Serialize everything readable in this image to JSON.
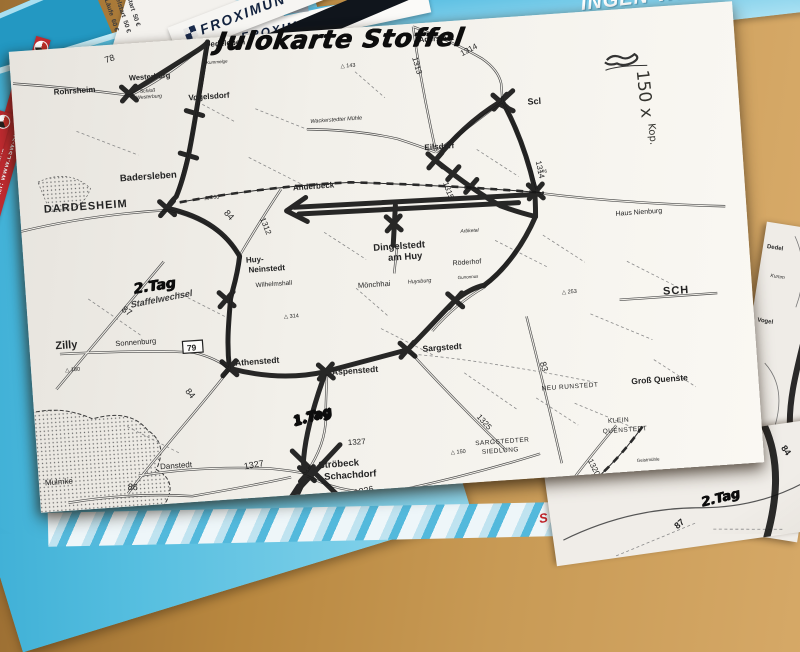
{
  "handwriting": {
    "title": "Julokarte Stoffel",
    "copies": "150 x",
    "copies_unit": "Kop.",
    "day1": "1.Tag",
    "day2": "2.Tag",
    "relay": "Staffelwechsel",
    "day2_other_sheet": "2.Tag"
  },
  "flyers": {
    "froximun": "FROXIMUN",
    "banner_big": "INGEN-WER",
    "banner_dates": "m 31.07.-03.08.201",
    "banner_small": "berstadt",
    "stripe_text": "Alle weiteren Info's und Wettkampfunterlagen unter: WWW.LSW-SPEZIAL",
    "ticket_distances": "7,5 km:\n15 km:\n22,5 k",
    "ticket_prices": "Einzelstart  50 €\nDoppelstart  50 €\nAlle Läufe  60 €",
    "ticket_red": "St",
    "bottom_red": "S"
  },
  "under_sheet": {
    "labels": [
      {
        "t": "Dedel"
      },
      {
        "t": "Kumm"
      },
      {
        "t": "Vogel"
      }
    ]
  },
  "second_sheet": {
    "road": "87",
    "marker_road": "84",
    "day": "2.Tag"
  },
  "map": {
    "towns": [
      {
        "t": "Dedeleben",
        "x": 196,
        "y": 9,
        "s": 8,
        "w": 700
      },
      {
        "t": "Westerburg",
        "x": 118,
        "y": 37,
        "s": 7.5,
        "w": 700
      },
      {
        "t": "Schloß",
        "x": 128,
        "y": 50,
        "s": 5,
        "i": 1
      },
      {
        "t": "Westerburg",
        "x": 124,
        "y": 56,
        "s": 5,
        "i": 1
      },
      {
        "t": "Rohrsheim",
        "x": 42,
        "y": 46,
        "s": 8,
        "w": 700
      },
      {
        "t": "Vogelsdorf",
        "x": 176,
        "y": 61,
        "s": 8,
        "w": 700
      },
      {
        "t": "Kummelge",
        "x": 196,
        "y": 26,
        "s": 4.5,
        "i": 1
      },
      {
        "t": "Aderstadt",
        "x": 410,
        "y": 19,
        "s": 7.5,
        "w": 700
      },
      {
        "t": "Wackerstedter Mühle",
        "x": 296,
        "y": 92,
        "s": 5.5,
        "i": 1
      },
      {
        "t": "Eilsdorf",
        "x": 408,
        "y": 127,
        "s": 8,
        "w": 700
      },
      {
        "t": "Scl",
        "x": 514,
        "y": 89,
        "s": 9,
        "w": 700
      },
      {
        "t": "Badersleben",
        "x": 102,
        "y": 137,
        "s": 9.5,
        "w": 700
      },
      {
        "t": "Anderbeck",
        "x": 274,
        "y": 158,
        "s": 8,
        "w": 700
      },
      {
        "t": "DARDESHEIM",
        "x": 24,
        "y": 163,
        "s": 11,
        "w": 700,
        "sp": 1
      },
      {
        "t": "Haus Nienburg",
        "x": 594,
        "y": 206,
        "s": 7
      },
      {
        "t": "Huy-",
        "x": 222,
        "y": 227,
        "s": 8,
        "w": 700
      },
      {
        "t": "Neinstedt",
        "x": 224,
        "y": 237,
        "s": 8,
        "w": 700
      },
      {
        "t": "Wilhelmshall",
        "x": 230,
        "y": 252,
        "s": 6.5
      },
      {
        "t": "Dingelstedt",
        "x": 350,
        "y": 224,
        "s": 9.5,
        "w": 700
      },
      {
        "t": "am Huy",
        "x": 364,
        "y": 235,
        "s": 9.5,
        "w": 700
      },
      {
        "t": "Mönchhai",
        "x": 332,
        "y": 260,
        "s": 7.5
      },
      {
        "t": "Huysburg",
        "x": 382,
        "y": 259,
        "s": 5.5,
        "i": 1
      },
      {
        "t": "Röderhof",
        "x": 428,
        "y": 244,
        "s": 7
      },
      {
        "t": "Gunonnus",
        "x": 432,
        "y": 258,
        "s": 4.5,
        "i": 1
      },
      {
        "t": "Arbketal",
        "x": 438,
        "y": 212,
        "s": 5,
        "i": 1
      },
      {
        "t": "SCH",
        "x": 636,
        "y": 288,
        "s": 11,
        "w": 700,
        "sp": 1
      },
      {
        "t": "Zilly",
        "x": 26,
        "y": 300,
        "s": 11,
        "w": 700
      },
      {
        "t": "Sonnenburg",
        "x": 86,
        "y": 301,
        "s": 7.5
      },
      {
        "t": "Athenstedt",
        "x": 204,
        "y": 329,
        "s": 8.5,
        "w": 700
      },
      {
        "t": "Mulmke",
        "x": 6,
        "y": 435,
        "s": 8
      },
      {
        "t": "Danstedt",
        "x": 122,
        "y": 427,
        "s": 8
      },
      {
        "t": "Aspenstedt",
        "x": 300,
        "y": 345,
        "s": 8.5,
        "w": 700
      },
      {
        "t": "Sargstedt",
        "x": 392,
        "y": 328,
        "s": 8.5,
        "w": 700
      },
      {
        "t": "SARGSTEDTER",
        "x": 438,
        "y": 425,
        "s": 6.5,
        "sp": 0.5
      },
      {
        "t": "SIEDLUNG",
        "x": 444,
        "y": 434,
        "s": 6.5,
        "sp": 0.5
      },
      {
        "t": "Ströbeck",
        "x": 280,
        "y": 437,
        "s": 9.5,
        "w": 700
      },
      {
        "t": "Schachdorf",
        "x": 285,
        "y": 449,
        "s": 9.5,
        "w": 700
      },
      {
        "t": "NEU RUNSTEDT",
        "x": 508,
        "y": 375,
        "s": 6.5,
        "sp": 0.5
      },
      {
        "t": "Groß Quenste",
        "x": 598,
        "y": 375,
        "s": 8.5,
        "w": 700
      },
      {
        "t": "KLEIN",
        "x": 572,
        "y": 412,
        "s": 6.5,
        "sp": 0.5
      },
      {
        "t": "QUENSTEDT",
        "x": 566,
        "y": 422,
        "s": 6.5,
        "sp": 0.5
      },
      {
        "t": "WEHRSTEDT",
        "x": 538,
        "y": 467,
        "s": 7,
        "sp": 0.5
      },
      {
        "t": "Geistmühle",
        "x": 598,
        "y": 453,
        "s": 4.5
      }
    ],
    "road_numbers": [
      {
        "t": "78",
        "x": 96,
        "y": 18,
        "r": -14,
        "s": 9
      },
      {
        "t": "84",
        "x": 203,
        "y": 176,
        "r": 52,
        "s": 9
      },
      {
        "t": "1312",
        "x": 239,
        "y": 184,
        "r": 72,
        "s": 8
      },
      {
        "t": "87",
        "x": 94,
        "y": 266,
        "r": 38,
        "s": 9
      },
      {
        "t": "84",
        "x": 152,
        "y": 351,
        "r": 55,
        "s": 9
      },
      {
        "t": "86",
        "x": 88,
        "y": 445,
        "r": 8,
        "s": 9
      },
      {
        "t": "1313",
        "x": 402,
        "y": 34,
        "r": 78,
        "s": 8
      },
      {
        "t": "1314",
        "x": 452,
        "y": 36,
        "r": -24,
        "s": 8
      },
      {
        "t": "1314",
        "x": 518,
        "y": 146,
        "r": 82,
        "s": 8
      },
      {
        "t": "1315",
        "x": 424,
        "y": 161,
        "r": 74,
        "s": 8
      },
      {
        "t": "1325",
        "x": 441,
        "y": 397,
        "r": 52,
        "s": 8
      },
      {
        "t": "1326",
        "x": 314,
        "y": 467,
        "r": -8,
        "s": 9
      },
      {
        "t": "1327",
        "x": 206,
        "y": 433,
        "r": -6,
        "s": 9
      },
      {
        "t": "1327",
        "x": 311,
        "y": 416,
        "r": 0,
        "s": 8
      },
      {
        "t": "1320",
        "x": 549,
        "y": 448,
        "r": 68,
        "s": 8
      },
      {
        "t": "83",
        "x": 508,
        "y": 347,
        "r": 78,
        "s": 9
      },
      {
        "t": "176",
        "x": 521,
        "y": 158,
        "r": 0,
        "s": 4.5
      }
    ],
    "boxed_numbers": [
      {
        "t": "79",
        "x": 163,
        "y": 310
      },
      {
        "t": "81",
        "x": 618,
        "y": 485
      }
    ],
    "elevations": [
      {
        "t": "260",
        "x": 185,
        "y": 161
      },
      {
        "t": "180",
        "x": 34,
        "y": 323
      },
      {
        "t": "314",
        "x": 256,
        "y": 285
      },
      {
        "t": "150",
        "x": 413,
        "y": 432
      },
      {
        "t": "253",
        "x": 535,
        "y": 280
      },
      {
        "t": "62",
        "x": 634,
        "y": 469
      },
      {
        "t": "143",
        "x": 330,
        "y": 39
      }
    ]
  }
}
